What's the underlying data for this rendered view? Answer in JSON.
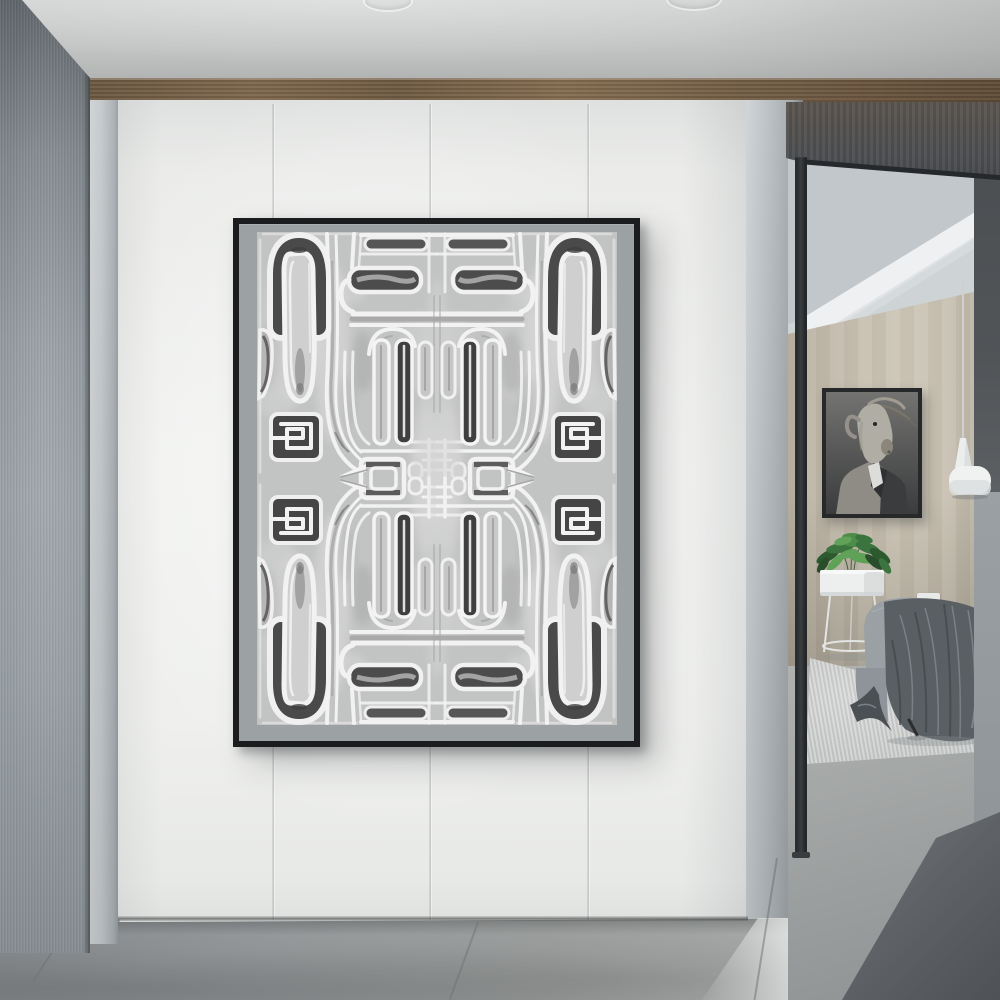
{
  "scene": {
    "type": "interior-photograph",
    "title": "Modern hallway with abstract wall art and bedroom doorway",
    "hallway": {
      "wall": "white large-format panels with vertical seams",
      "trim": "walnut wood band below ceiling",
      "left_wall": "dark gray ribbed panel",
      "floor": "large gray concrete tiles"
    },
    "artwork": {
      "frame": "thin black metal",
      "mat": "gray border",
      "style": "black and white abstract tribal maze pattern, 4-fold mirror symmetry",
      "motifs": [
        "elongated tongue shapes",
        "meander 2-glyphs",
        "dark square spirals",
        "nested line fans",
        "center chevron arrows"
      ]
    },
    "doorway_room": {
      "wall": "warm tan paneling",
      "ceiling": "sloped with white beam",
      "items": [
        "black-framed portrait of a suited animal figure",
        "white cone pendant lamp on cord",
        "green potted plant on white ring stand",
        "gray armchair draped with dark throw blanket",
        "light textured area rug",
        "small white wall socket"
      ]
    }
  },
  "palette": {
    "ceilingA": "#d2d4d3",
    "ceilingB": "#aeb0af",
    "woodA": "#7d664c",
    "woodB": "#5e4b36",
    "leftWallA": "#5f656a",
    "leftWallB": "#9aa1a6",
    "columnA": "#cdd2d5",
    "columnB": "#969da1",
    "whiteWall": "#f1f2f0",
    "pillarA": "#c2c8cb",
    "pillarB": "#8f959a",
    "soffitA": "#5a544d",
    "soffitB": "#45474a",
    "frameBlack": "#1a1c1e",
    "matGray": "#9ca1a3",
    "printBg": "#c2c3c3",
    "printDark": "#474747",
    "printWhite": "#f2f2f2",
    "printMid": "#a6a6a6",
    "tanA": "#cdc6b7",
    "tanB": "#b2ab9d",
    "roomCeil": "#ced3d6",
    "beamWhite": "#eef0f1",
    "bandDark": "#515558",
    "bandLight": "#9aa0a3",
    "floorA": "#83878a",
    "floorB": "#b3b5b3",
    "roomFloorA": "#b4b6b5",
    "roomFloorB": "#8f9293",
    "rug": "#c8cac9",
    "wedgeA": "#7c8084",
    "wedgeB": "#4e5256",
    "chairGray": "#9aa0a4",
    "blanket": "#5a5f64",
    "blanketDark": "#4b5055",
    "plantGreen": "#3c7440",
    "potWhite": "#edefef",
    "portraitBgA": "#737472",
    "portraitBgB": "#3b3c3e"
  }
}
